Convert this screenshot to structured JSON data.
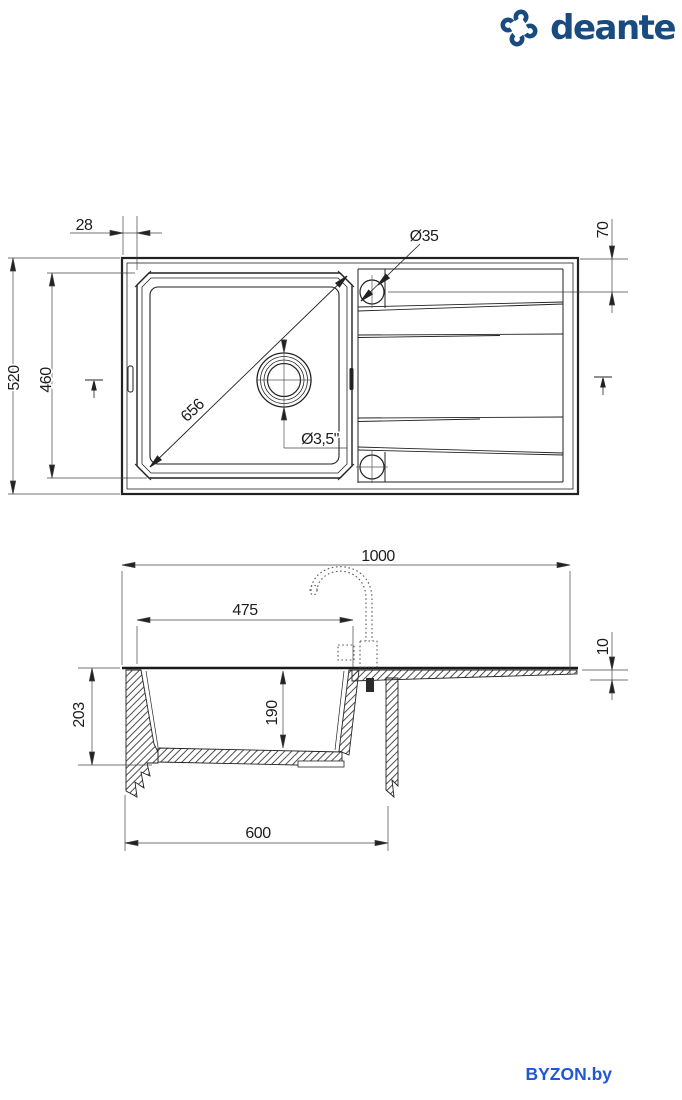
{
  "brand": {
    "name": "deante",
    "icon": "deante-pinwheel-icon",
    "color": "#1a4b80"
  },
  "watermark": {
    "text": "BYZON.by",
    "color": "#2156d4"
  },
  "drawing": {
    "line_color": "#222222",
    "description": "Kitchen sink technical drawing, top view and sectional side view, dimensions in mm",
    "top_view": {
      "dims": {
        "edge_offset": "28",
        "overall_depth": "520",
        "bowl_depth": "460",
        "tap_hole_offset": "70",
        "tap_hole_diameter": "Ø35",
        "bowl_diagonal": "656",
        "drain_diameter": "Ø3,5\""
      }
    },
    "side_view": {
      "dims": {
        "overall_length": "1000",
        "bowl_length": "475",
        "board_thickness": "10",
        "bowl_outer_height": "203",
        "bowl_inner_depth": "190",
        "cabinet_width": "600"
      }
    }
  }
}
